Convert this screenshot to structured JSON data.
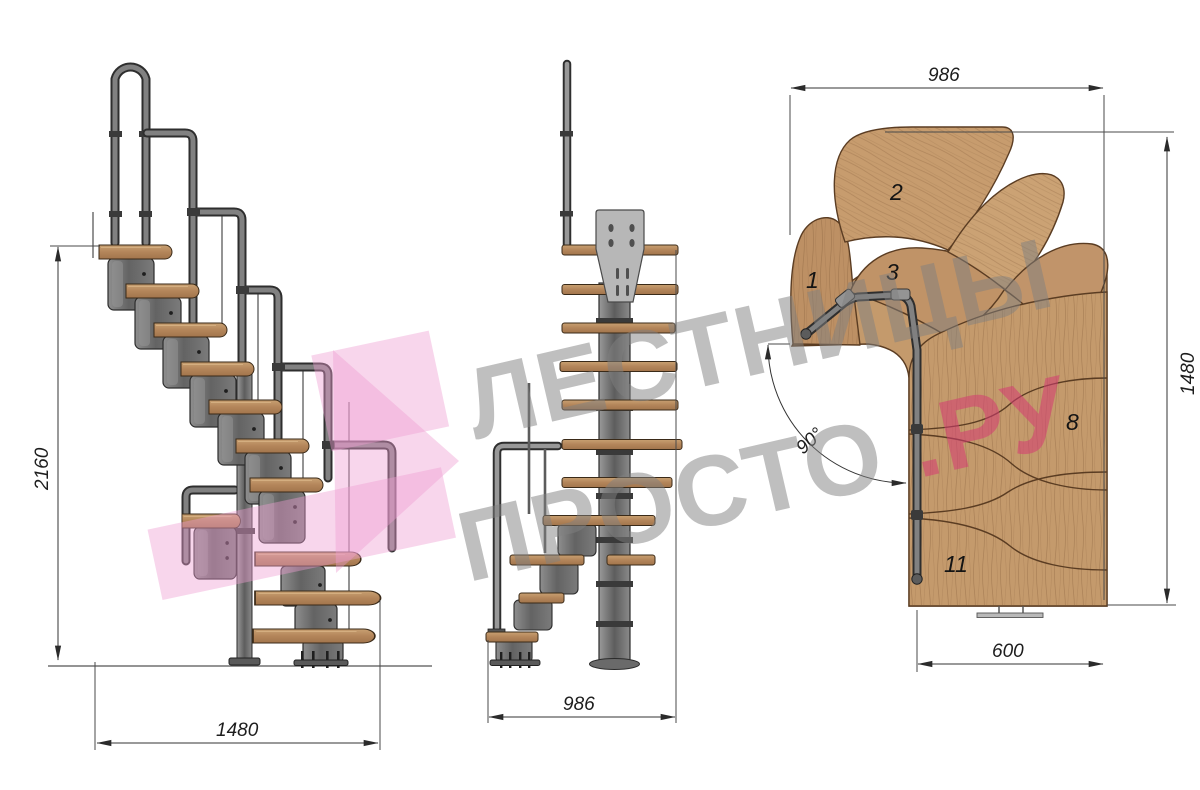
{
  "title": "Modular staircase technical drawing",
  "watermark": {
    "line1": "ЛЕСТНИЦЫ",
    "line2_main": "ПРОСТО",
    "line2_accent": ".РУ"
  },
  "views": {
    "side": {
      "label": "side elevation",
      "dim_height": "2160",
      "dim_width": "1480"
    },
    "front": {
      "label": "front elevation",
      "dim_width": "986"
    },
    "plan": {
      "label": "plan view",
      "dim_top": "986",
      "dim_right": "1480",
      "dim_bottom": "600",
      "angle": "90°",
      "steps": {
        "n1": "1",
        "n2": "2",
        "n3": "3",
        "n8": "8",
        "n11": "11"
      }
    }
  },
  "colors": {
    "wood": "#c49a6c",
    "wood_outline": "#5a3c22",
    "metal": "#6f6f6f",
    "metal_dark": "#2d2d2d",
    "accent_red": "#d63a72",
    "watermark_gray": "#808080",
    "watermark_pink": "#ee9ed2",
    "dim_line": "#333333"
  }
}
